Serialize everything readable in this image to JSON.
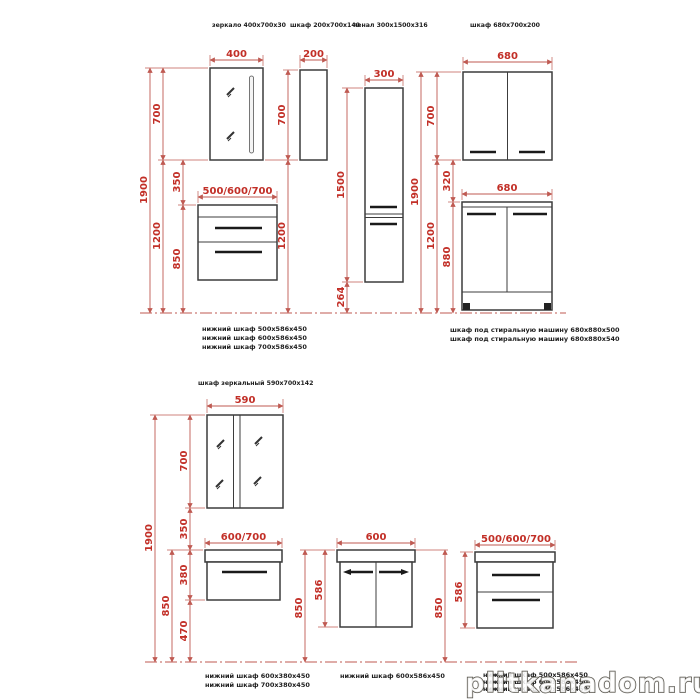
{
  "colors": {
    "dimension_line": "#bf5a52",
    "dimension_text": "#c22f27",
    "outline": "#3c3c3c",
    "caption_text": "#1c1c1c",
    "watermark_fill": "#ffffff",
    "watermark_outline": "#55524a"
  },
  "top_row": {
    "titles": [
      "зеркало 400x700x30",
      "шкаф 200x700x140",
      "пенал 300x1500x316",
      "шкаф 680x700x200"
    ],
    "mirror_unit": {
      "width": "400",
      "total_height": "1900",
      "mirror_height": "700",
      "under_height": "1200",
      "gap": "350",
      "cabinet_height": "850",
      "cabinet_width": "500/600/700"
    },
    "wall_cabinet": {
      "width": "200",
      "height": "700",
      "under_height": "1200"
    },
    "tall_cabinet": {
      "width": "300",
      "height": "1500",
      "under_height": "264"
    },
    "double_unit": {
      "top_width": "680",
      "top_height": "700",
      "total_height": "1900",
      "under_height": "1200",
      "gap": "320",
      "bottom_width": "680",
      "bottom_height": "880"
    },
    "captions_left": [
      "нижний шкаф  500x586x450",
      "нижний шкаф  600x586x450",
      "нижний шкаф  700x586x450"
    ],
    "captions_right": [
      "шкаф под стиральную машину 680x880x500",
      "шкаф под стиральную машину 680x880x540"
    ]
  },
  "bottom_row": {
    "title": "шкаф зеркальный 590x700x142",
    "mirror_unit": {
      "width": "590",
      "total_height": "1900",
      "mount_height": "850",
      "mirror_height": "700",
      "gap": "350",
      "cabinet_height": "380",
      "under_height": "470",
      "cabinet_width": "600/700"
    },
    "door_cabinet": {
      "width": "600",
      "height": "586",
      "mount_left": "850",
      "mount_right": "850"
    },
    "drawer_cabinet": {
      "width": "500/600/700",
      "height": "586"
    },
    "captions_left": [
      "нижний шкаф  600x380x450",
      "нижний шкаф  700x380x450"
    ],
    "caption_mid": "нижний шкаф  600x586x450",
    "captions_right": [
      "нижний шкаф  500x586x450",
      "нижний шкаф  600x586x450",
      "нижний шкаф  700x586x450"
    ]
  },
  "watermark": "plitkanadom.ru"
}
